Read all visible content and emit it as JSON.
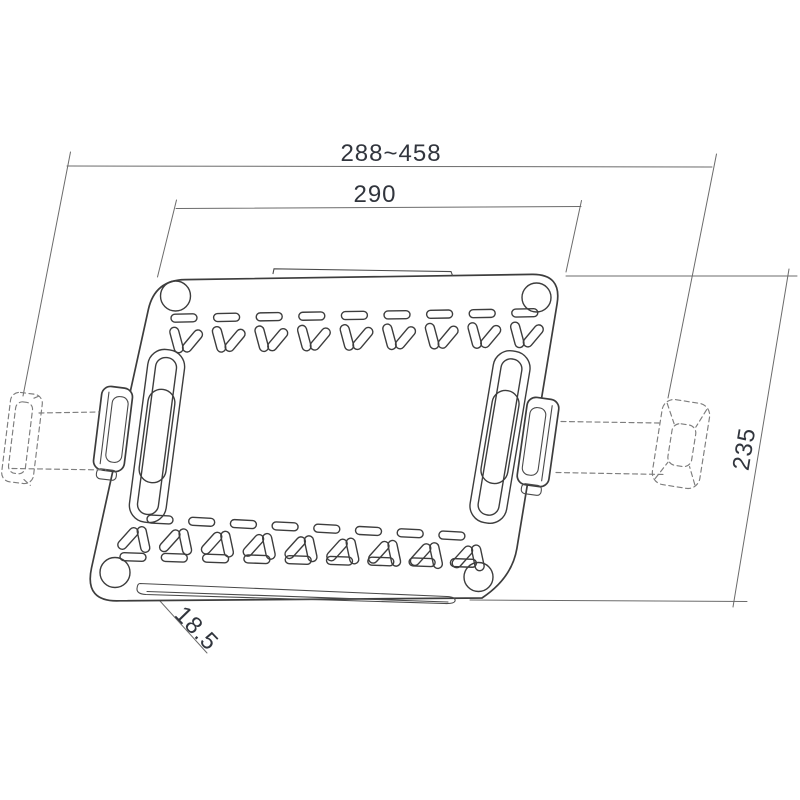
{
  "drawing": {
    "labels": {
      "adjustable_width": "288~458",
      "plate_width": "290",
      "depth": "235",
      "lip_height": "18.5"
    },
    "colors": {
      "background": "#ffffff",
      "outline": "#3d3d3d",
      "dimension_lines": "#6b6b6b",
      "hidden_lines": "#7d7d7d",
      "dimension_text": "#31353d"
    }
  }
}
